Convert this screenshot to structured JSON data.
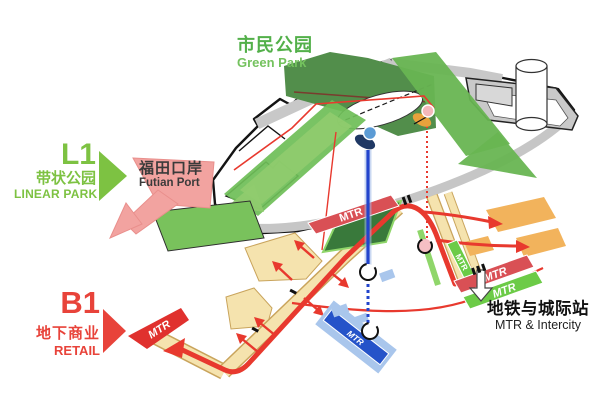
{
  "diagram": {
    "green_park": {
      "zh": "市民公园",
      "en": "Green Park"
    },
    "linear_park": {
      "code": "L1",
      "zh": "带状公园",
      "en": "LINEAR PARK"
    },
    "futian_port": {
      "zh": "福田口岸",
      "en": "Futian Port"
    },
    "retail": {
      "code": "B1",
      "zh": "地下商业",
      "en": "RETAIL"
    },
    "station": {
      "zh": "地铁与城际站",
      "en": "MTR & Intercity"
    },
    "mtr_label": "MTR",
    "colors": {
      "label_green": "#7DC242",
      "label_red": "#E8433A",
      "deck_dark_green": "#528E4B",
      "band_green": "#6FBE58",
      "retail_cream": "#F5E3AE",
      "platform_orange": "#F2B35C",
      "route_red": "#E8392E",
      "mtr_bar_red": "#D95055",
      "mtr_bar_green": "#6CCB47",
      "mtr_blue": "#2553C9",
      "light_blue": "#A9C6EC",
      "futian_pink": "#F2A3A0",
      "label_dark": "#3A3A3A"
    }
  }
}
